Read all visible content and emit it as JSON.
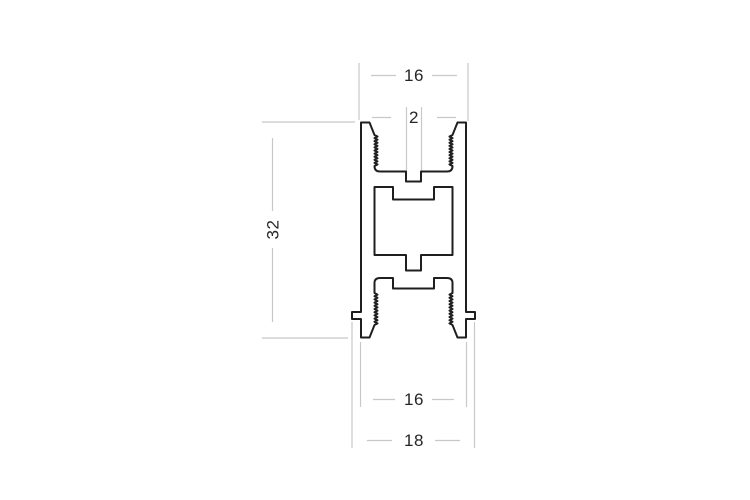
{
  "drawing": {
    "dimensions": {
      "top_width": "16",
      "slot_width": "2",
      "height": "32",
      "bottom_width": "16",
      "bottom_overall_width": "18"
    },
    "colors": {
      "outline": "#1f1f1f",
      "dimension_lines": "#c8c8c8",
      "dimension_text": "#262626",
      "background": "#ffffff"
    }
  }
}
